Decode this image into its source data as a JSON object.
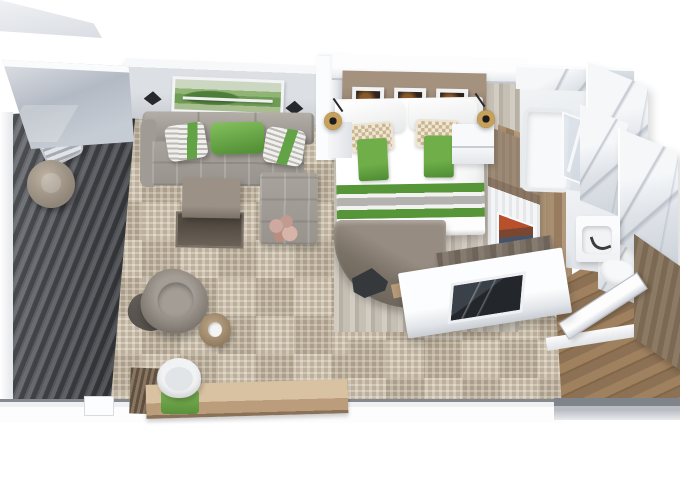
{
  "scene": {
    "title": "Isometric 3D floor plan render of a suite cabin with private balcony",
    "type": "3d-floorplan-render",
    "background": "#ffffff"
  },
  "palette": {
    "accent_green": "#5d9b3f",
    "sofa_gray": "#9a948c",
    "carpet_beige": "#c6b9a6",
    "deck_plank_dark": "#45474b",
    "canopy_glass": "#b7bdc7",
    "marble_white": "#eef1f4",
    "marble_vein": "#8c94a3",
    "headboard_wood": "#8d7b6a",
    "entry_wood": "#94785a",
    "wall_white": "#f4f5f7",
    "furniture_taupe": "#857c72",
    "tv_screen_dark": "#2e3338",
    "pendant_brass": "#c7a05a"
  },
  "rooms": {
    "balcony": {
      "label": "Balcony with glass canopy, deck chair and round side table on dark plank decking",
      "items": [
        "glass-canopy",
        "plank-decking",
        "deck-chair",
        "round-side-table"
      ]
    },
    "living_room": {
      "label": "Living room with L-shaped sofa, green accent pillows, landscape wall art, coffee table, armchair and writing desk",
      "items": [
        "l-shaped-sofa",
        "green-accent-pillows",
        "striped-pillows",
        "wall-art-landscape",
        "wall-sconces",
        "nesting-coffee-table",
        "lounge-armchair",
        "ottoman",
        "drum-side-table",
        "writing-desk",
        "desk-chair-green-cushion",
        "slatted-bench",
        "carpet-tiles",
        "flower-decor"
      ]
    },
    "bedroom": {
      "label": "Bedroom with double bed, green striped runner, headboard gallery wall, nightstands, brass pendant lamps, curved dresser and TV partition",
      "items": [
        "double-bed",
        "green-striped-runner",
        "patterned-pillows",
        "headboard-art-frames",
        "nightstand",
        "brass-pendant-lamp",
        "curved-dresser",
        "tv-partition-wall",
        "tv-screen",
        "wardrobe-cabinet",
        "framed-artwork"
      ]
    },
    "bathroom": {
      "label": "Marble bathroom suite with bathtub, glass shower, sink vanity and toilet",
      "items": [
        "marble-walls",
        "bathtub",
        "glass-shower",
        "sink-vanity",
        "toilet"
      ]
    },
    "entry": {
      "label": "Entry hall with wood floor, open cabin door and closet wall",
      "items": [
        "wood-floor",
        "cabin-door",
        "closet-wall"
      ]
    }
  }
}
